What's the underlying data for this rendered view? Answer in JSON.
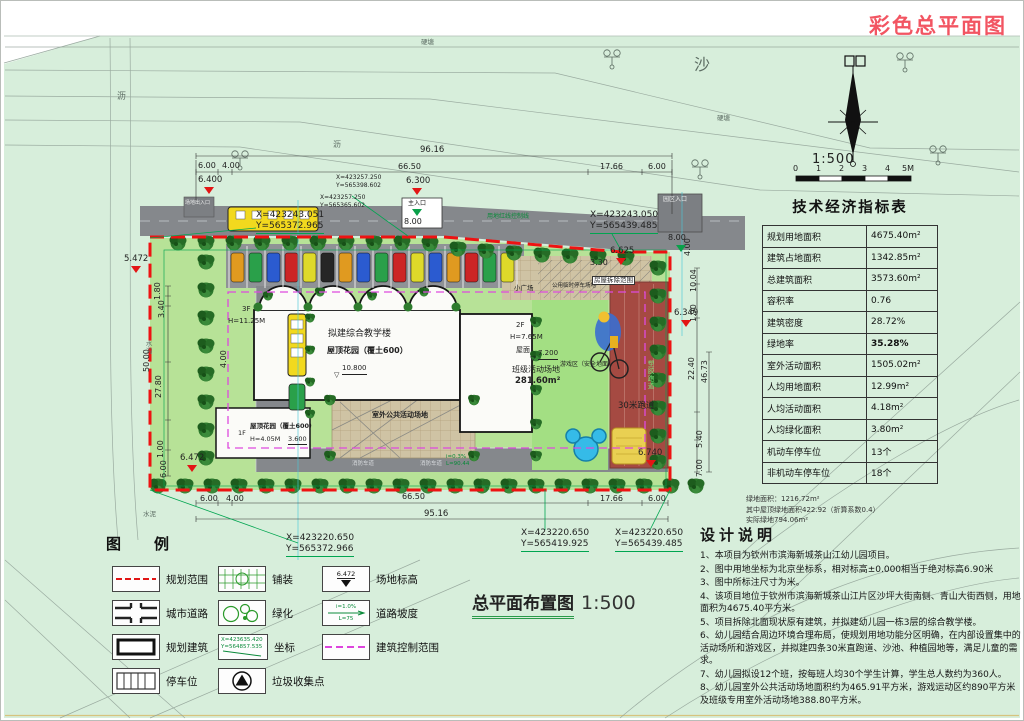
{
  "page": {
    "title": "彩色总平面图",
    "plan_title": "总平面布置图",
    "plan_scale": "1:500"
  },
  "north_scale": {
    "ratio": "1:500",
    "ticks": [
      "0",
      "1",
      "2",
      "3",
      "4",
      "5M"
    ]
  },
  "indicator_table": {
    "title": "技术经济指标表",
    "rows": [
      {
        "label": "规划用地面积",
        "value": "4675.40m²"
      },
      {
        "label": "建筑占地面积",
        "value": "1342.85m²"
      },
      {
        "label": "总建筑面积",
        "value": "3573.60m²"
      },
      {
        "label": "容积率",
        "value": "0.76"
      },
      {
        "label": "建筑密度",
        "value": "28.72%"
      },
      {
        "label": "绿地率",
        "value": "35.28%"
      },
      {
        "label": "室外活动面积",
        "value": "1505.02m²"
      },
      {
        "label": "人均用地面积",
        "value": "12.99m²"
      },
      {
        "label": "人均活动面积",
        "value": "4.18m²"
      },
      {
        "label": "人均绿化面积",
        "value": "3.80m²"
      },
      {
        "label": "机动车停车位",
        "value": "13个"
      },
      {
        "label": "非机动车停车位",
        "value": "18个"
      }
    ],
    "footnotes": [
      "绿地面积：1216.72m²",
      "其中屋顶绿地面积422.92（折算系数0.4）",
      "实际绿地794.06m²"
    ]
  },
  "design_notes": {
    "title": "设计说明",
    "items": [
      "1、本项目为钦州市滨海新城茶山江幼儿园项目。",
      "2、图中用地坐标为北京坐标系，相对标高±0.000相当于绝对标高6.90米",
      "3、图中所标注尺寸为米。",
      "4、该项目地位于钦州市滨海新城茶山江片区沙坪大街南侧、青山大街西侧，用地面积为4675.40平方米。",
      "5、项目拆除北面现状原有建筑，并拟建幼儿园一栋3层的综合教学楼。",
      "6、幼儿园结合周边环境合理布局，使规划用地功能分区明确，在内部设置集中的活动场所和游戏区，并拟建四条30米直跑道、沙池、种植园地等，满足儿童的需求。",
      "7、幼儿园拟设12个班，按每班人均30个学生计算，学生总人数约为360人。",
      "8、幼儿园室外公共活动场地面积约为465.91平方米，游戏运动区约890平方米及班级专用室外活动场地388.80平方米。"
    ]
  },
  "legend": {
    "title": "图　例",
    "items": {
      "planning_boundary": "规划范围",
      "city_road": "城市道路",
      "planned_building": "规划建筑",
      "parking": "停车位",
      "paving": "铺装",
      "greening": "绿化",
      "coordinate": "坐标",
      "garbage": "垃圾收集点",
      "site_elevation": "场地标高",
      "road_slope": "道路坡度",
      "building_control": "建筑控制范围"
    },
    "swatch_text": {
      "coordinate_x": "X=423635.420",
      "coordinate_y": "Y=564857.535",
      "site_elevation": "6.472",
      "road_slope_i": "i=1.0%",
      "road_slope_l": "L=75"
    }
  },
  "plan": {
    "coordinates": {
      "c1x": "X=423257.250",
      "c1y": "Y=565398.602",
      "c2x": "X=423257.250",
      "c2y": "Y=565365.602",
      "c3x": "X=423243.051",
      "c3y": "Y=565372.965",
      "c4x": "X=423243.050",
      "c4y": "Y=565439.485",
      "c5x": "X=423220.650",
      "c5y": "Y=565372.966",
      "c6x": "X=423220.650",
      "c6y": "Y=565419.925",
      "c7x": "X=423220.650",
      "c7y": "Y=565439.485"
    },
    "dims": {
      "top_total": "96.16",
      "t1": "6.00",
      "t2": "4.00",
      "t3": "66.50",
      "t4": "17.66",
      "t5": "6.00",
      "b1": "6.00",
      "b2": "4.00",
      "b3": "66.50",
      "b4": "17.66",
      "b5": "6.00",
      "bottom_total": "95.16",
      "l1": "1.80",
      "l2": "3.40",
      "l3": "50.00",
      "l4": "27.80",
      "l5": "1.00",
      "l6": "6.00",
      "r1": "10.04",
      "r2": "1.90",
      "r3": "22.40",
      "r4": "46.73",
      "r5": "5.40",
      "r6": "7.00",
      "road_w": "4.00",
      "r_gate": "4.00",
      "p1": "3.30",
      "gate_w": "8.00",
      "gate2_w": "8.00"
    },
    "levels": {
      "e1": "6.400",
      "e2": "6.300",
      "e3": "6.625",
      "e4": "5.472",
      "e5": "6.349",
      "e6": "6.472",
      "e7": "6.740"
    },
    "labels": {
      "main_building": "拟建综合教学楼",
      "roof_garden": "屋顶花园（覆土600）",
      "main_floors": "3F",
      "main_height": "H=11.25M",
      "main_level": "10.800",
      "wing_floors": "2F",
      "wing_height": "H=7.65M",
      "wing_roof": "屋面",
      "wing_level": "7.200",
      "class_field": "班级活动场地",
      "class_area": "281.60m²",
      "small_floors": "1F",
      "small_roof": "屋顶花园（覆土600）",
      "small_height": "H=4.05M",
      "small_level": "3.600",
      "plaza": "室外公共活动场地",
      "play_area": "游戏区（安全地面）",
      "track": "30米跑道",
      "track_side": "塑胶跑道",
      "demolition": "房屋拆除范围",
      "small_square": "小广场",
      "temp_parking": "公用临时停车场地",
      "red_line": "用地红线控制线",
      "fire_lane": "消防车道",
      "slope_i": "i=0.3%",
      "slope_l": "L=90.44",
      "gate_main": "主入口",
      "gate_side": "园区入口",
      "side_entry": "场地出入口",
      "ditch": "水沟",
      "cement": "水泥"
    },
    "bg": {
      "sand": "沙",
      "pond1": "硬塘",
      "pond2": "硬塘",
      "road_name1": "沥",
      "road_name2": "沥"
    }
  }
}
